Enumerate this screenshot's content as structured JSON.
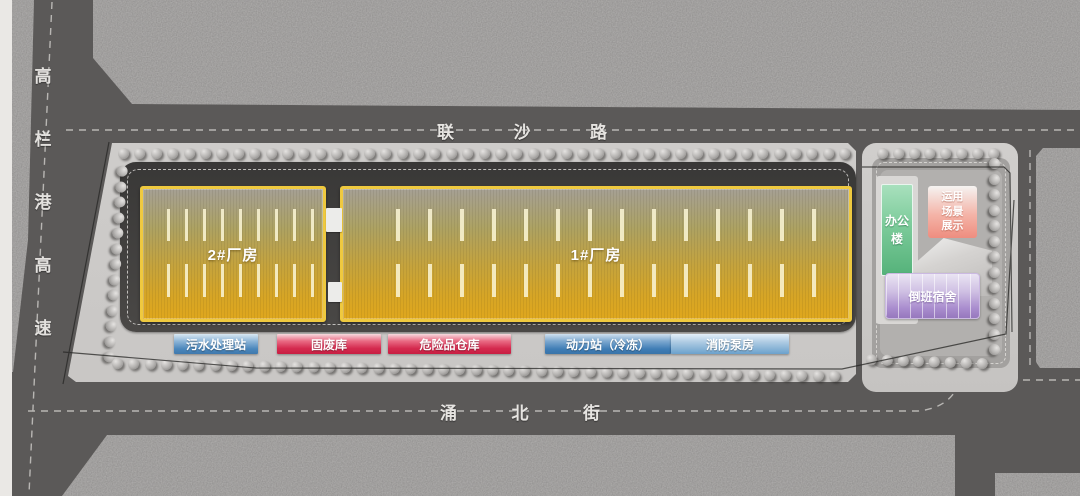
{
  "roads": {
    "left": {
      "name": "高栏港高速",
      "chars": [
        "高",
        "栏",
        "港",
        "高",
        "速"
      ]
    },
    "top": {
      "name": "联沙路",
      "chars": [
        "联",
        "沙",
        "路"
      ]
    },
    "bottom": {
      "name": "涌北街",
      "chars": [
        "涌",
        "北",
        "街"
      ]
    }
  },
  "buildings": {
    "factory1": {
      "label": "1#厂房",
      "color": "#d9a41e"
    },
    "factory2": {
      "label": "2#厂房",
      "color": "#d9a41e"
    },
    "office": {
      "label": "办公楼",
      "color": "#67c28f"
    },
    "display": {
      "label": "运用场景展示",
      "lines": [
        "运用",
        "场景",
        "展示"
      ],
      "color": "#ef9184"
    },
    "dormitory": {
      "label": "倒班宿舍",
      "color": "#9b7cc4"
    }
  },
  "facilities": [
    {
      "label": "污水处理站",
      "type": "blue",
      "color": "#4a86bb"
    },
    {
      "label": "固废库",
      "type": "red",
      "color": "#d52a4d"
    },
    {
      "label": "危险品仓库",
      "type": "red",
      "color": "#d52a4d"
    },
    {
      "label": "动力站（冷冻）",
      "type": "blue",
      "color": "#3f7db5"
    },
    {
      "label": "消防泵房",
      "type": "lightblue",
      "color": "#7fb2d9"
    }
  ],
  "palette": {
    "road": "#5b5958",
    "land": "#8e8c8b",
    "sidewalk": "#cac8c6",
    "ring_road": "#454442",
    "factory_border": "#eec53e"
  }
}
